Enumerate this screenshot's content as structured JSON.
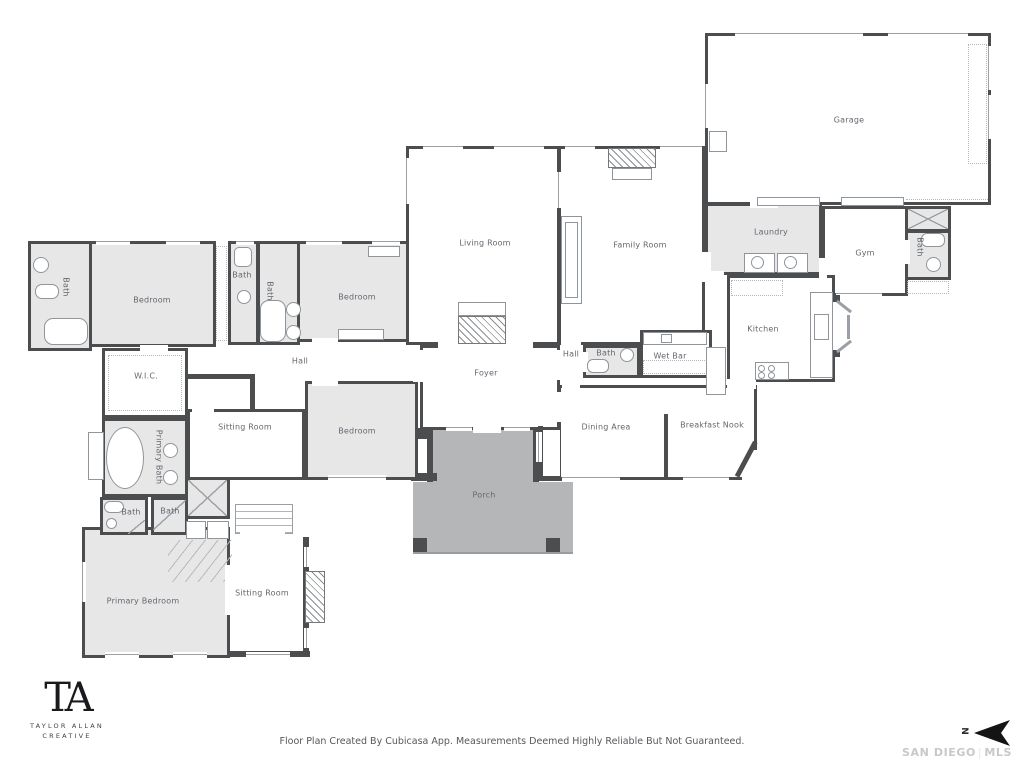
{
  "rooms": {
    "garage": "Garage",
    "laundry": "Laundry",
    "gym": "Gym",
    "kitchen": "Kitchen",
    "family_room": "Family Room",
    "living_room": "Living Room",
    "foyer": "Foyer",
    "hall_west": "Hall",
    "hall_east": "Hall",
    "wet_bar": "Wet Bar",
    "dining_area": "Dining Area",
    "breakfast_nook": "Breakfast Nook",
    "porch": "Porch",
    "wic": "W.I.C.",
    "bedroom_nw": "Bedroom",
    "bedroom_n": "Bedroom",
    "bedroom_mid": "Bedroom",
    "sitting_room_upper": "Sitting Room",
    "sitting_room_lower": "Sitting Room",
    "bath_west": "Bath",
    "bath_small": "Bath",
    "bath_jack_jill": "Bath",
    "bath_hall": "Bath",
    "bath_gym": "Bath",
    "bath_primary_wc": "Bath",
    "bath_primary_shower": "Bath",
    "primary_bath": "Primary Bath",
    "primary_bedroom": "Primary Bedroom"
  },
  "footer": {
    "disclaimer": "Floor Plan Created By Cubicasa App. Measurements Deemed Highly Reliable But Not Guaranteed."
  },
  "branding": {
    "monogram": "TA",
    "name_line1": "TAYLOR ALLAN",
    "name_line2": "CREATIVE"
  },
  "compass": {
    "north_label": "N"
  },
  "watermark": {
    "text_left": "SAN DIEGO",
    "separator": "|",
    "text_right": "MLS"
  },
  "colors": {
    "wall": "#4c4d4f",
    "room_fill": "#e7e7e8",
    "porch_fill": "#b5b6b7",
    "label_text": "#63686e",
    "watermark_text": "#c8c8c8",
    "logo_text": "#1a1a1e",
    "disclaimer_text": "#54585c"
  }
}
